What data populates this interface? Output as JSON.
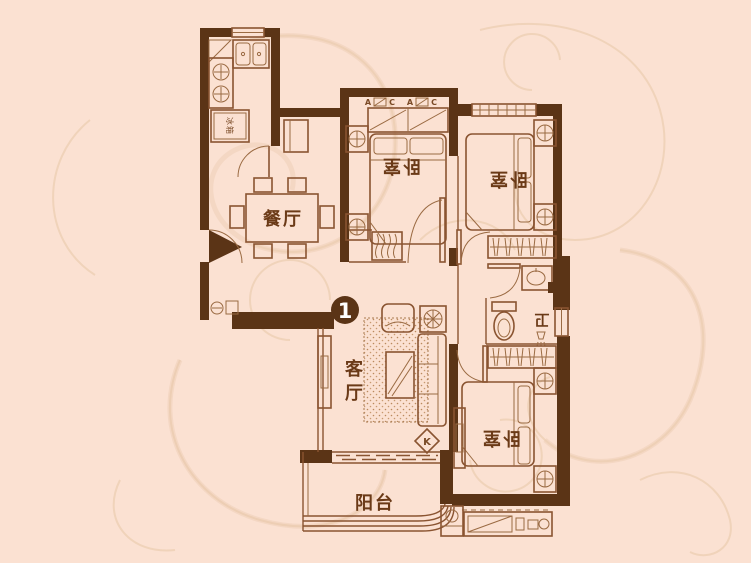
{
  "palette": {
    "background": "#fbe1d2",
    "wall": "#5b3416",
    "furniture_line": "#8a5431",
    "decor_swirl": "#ecceb2",
    "label_text": "#6b3a17",
    "badge_background": "#5b3416",
    "badge_text": "#ffffff"
  },
  "floorplan": {
    "unit_badge": "1",
    "rooms": {
      "dining": "餐厅",
      "bedroom_top": "卧室",
      "bedroom_right": "卧室",
      "bedroom_bottom": "卧室",
      "bathroom": "卫",
      "living_line1": "客",
      "living_line2": "厅",
      "balcony": "阳台"
    },
    "appliances": {
      "fridge": "冰箱"
    },
    "markers": {
      "ac": "K",
      "wardrobe_a": "A",
      "wardrobe_c": "C"
    }
  }
}
